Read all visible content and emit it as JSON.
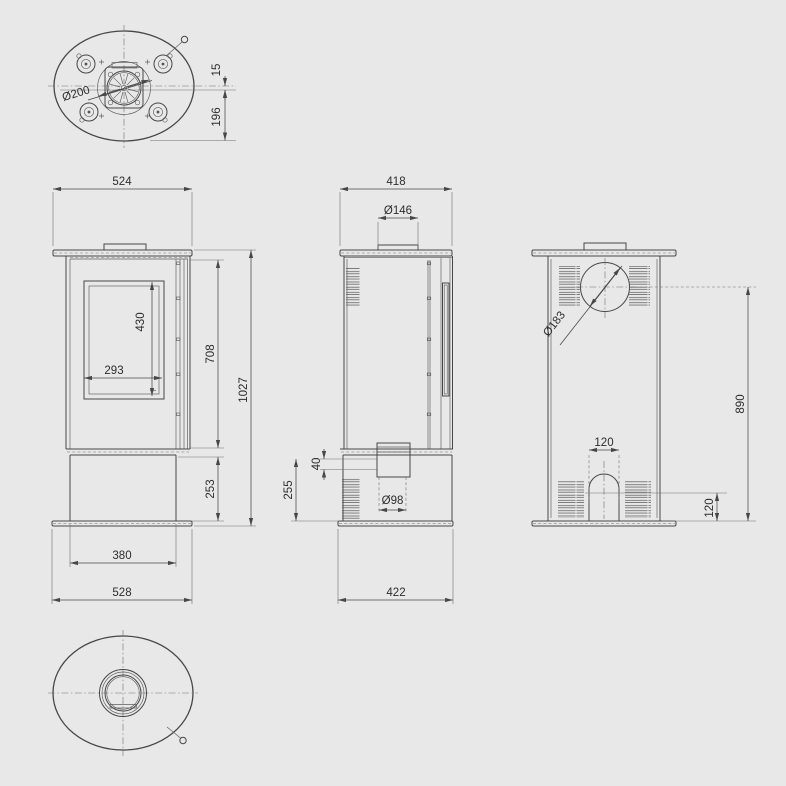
{
  "drawing": {
    "subject": "free-standing stove technical dimension drawing",
    "units": "mm",
    "colors": {
      "background": "#e8e8e8",
      "line": "#474747",
      "dimension_text": "#2d2d2d"
    }
  },
  "views": {
    "top": {
      "label": "top-view",
      "dims": {
        "flue_diameter": "Ø200",
        "offset": "15",
        "center_depth": "196"
      }
    },
    "front": {
      "label": "front-view",
      "dims": {
        "top_width": "524",
        "glass_height": "430",
        "glass_width": "293",
        "upper_height": "708",
        "total_height": "1027",
        "base_height": "253",
        "body_width": "380",
        "base_width": "528"
      }
    },
    "side": {
      "label": "side-view",
      "dims": {
        "depth": "418",
        "flue_collar_diameter": "Ø146",
        "intake_offset": "40",
        "intake_center_height": "255",
        "intake_diameter": "Ø98",
        "base_depth": "422"
      }
    },
    "back": {
      "label": "back-view",
      "dims": {
        "rear_flue_diameter": "Ø183",
        "flue_center_height": "890",
        "arch_width": "120",
        "arch_height": "120"
      }
    },
    "bottom": {
      "label": "bottom-view",
      "dims": {}
    }
  }
}
